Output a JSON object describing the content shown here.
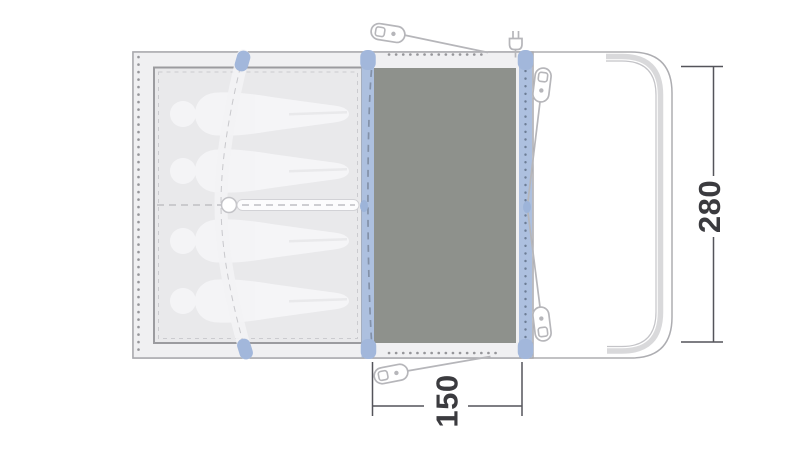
{
  "diagram": {
    "kind": "tent-floorplan-top-view",
    "dimensions": {
      "depth_label": "280",
      "door_width_label": "150"
    },
    "sleeping_area": {
      "person_silhouette_count": 4
    },
    "icons": {
      "peg": "peg-icon",
      "power_plug": "power-plug-icon"
    },
    "colors": {
      "canvas": "#ffffff",
      "fabric": "#f0f0f2",
      "bedroom_fill": "#e9e9eb",
      "groundsheet": "#8e918c",
      "pole_strip": "#adc0df",
      "pole_cap": "#a2b7db",
      "outline": "#adadb1",
      "guyline": "#b6b6ba",
      "dimension_line": "#54545a",
      "dimension_text": "#3b3b3f"
    }
  }
}
